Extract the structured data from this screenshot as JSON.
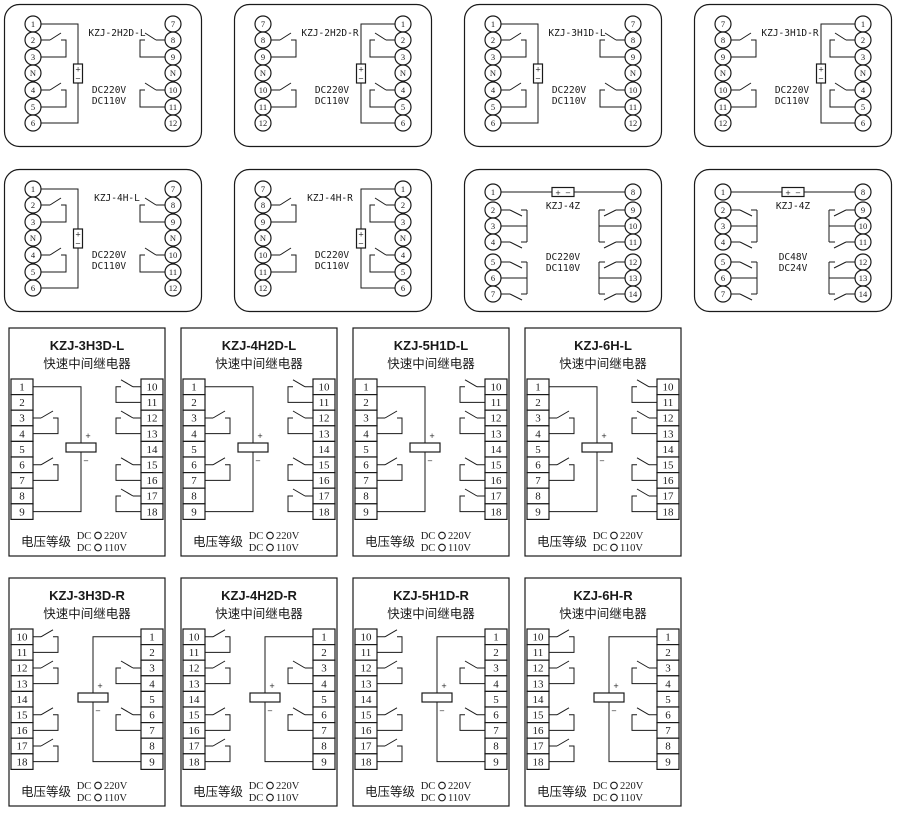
{
  "page": {
    "background": "#ffffff",
    "ink": "#1a1a1a"
  },
  "shared": {
    "plus": "+",
    "minus": "−"
  },
  "rows": [
    {
      "name": "row-1",
      "kind": "pill",
      "panels": [
        {
          "type": "pill-l",
          "title": "KZJ-2H2D-L",
          "voltages": [
            "DC220V",
            "DC110V"
          ],
          "left": [
            "1",
            "2",
            "3",
            "N",
            "4",
            "5",
            "6"
          ],
          "right": [
            "7",
            "8",
            "9",
            "N",
            "10",
            "11",
            "12"
          ]
        },
        {
          "type": "pill-r",
          "title": "KZJ-2H2D-R",
          "voltages": [
            "DC220V",
            "DC110V"
          ],
          "left": [
            "7",
            "8",
            "9",
            "N",
            "10",
            "11",
            "12"
          ],
          "right": [
            "1",
            "2",
            "3",
            "N",
            "4",
            "5",
            "6"
          ]
        },
        {
          "type": "pill-l",
          "title": "KZJ-3H1D-L",
          "voltages": [
            "DC220V",
            "DC110V"
          ],
          "left": [
            "1",
            "2",
            "3",
            "N",
            "4",
            "5",
            "6"
          ],
          "right": [
            "7",
            "8",
            "9",
            "N",
            "10",
            "11",
            "12"
          ]
        },
        {
          "type": "pill-r",
          "title": "KZJ-3H1D-R",
          "voltages": [
            "DC220V",
            "DC110V"
          ],
          "left": [
            "7",
            "8",
            "9",
            "N",
            "10",
            "11",
            "12"
          ],
          "right": [
            "1",
            "2",
            "3",
            "N",
            "4",
            "5",
            "6"
          ]
        }
      ]
    },
    {
      "name": "row-2",
      "kind": "pill",
      "panels": [
        {
          "type": "pill-l",
          "title": "KZJ-4H-L",
          "voltages": [
            "DC220V",
            "DC110V"
          ],
          "left": [
            "1",
            "2",
            "3",
            "N",
            "4",
            "5",
            "6"
          ],
          "right": [
            "7",
            "8",
            "9",
            "N",
            "10",
            "11",
            "12"
          ]
        },
        {
          "type": "pill-r",
          "title": "KZJ-4H-R",
          "voltages": [
            "DC220V",
            "DC110V"
          ],
          "left": [
            "7",
            "8",
            "9",
            "N",
            "10",
            "11",
            "12"
          ],
          "right": [
            "1",
            "2",
            "3",
            "N",
            "4",
            "5",
            "6"
          ]
        },
        {
          "type": "pill-z",
          "title": "KZJ-4Z",
          "voltages": [
            "DC220V",
            "DC110V"
          ],
          "left": [
            "1",
            "2",
            "3",
            "4",
            "5",
            "6",
            "7"
          ],
          "right": [
            "8",
            "9",
            "10",
            "11",
            "12",
            "13",
            "14"
          ]
        },
        {
          "type": "pill-z",
          "title": "KZJ-4Z",
          "voltages": [
            "DC48V",
            "DC24V"
          ],
          "left": [
            "1",
            "2",
            "3",
            "4",
            "5",
            "6",
            "7"
          ],
          "right": [
            "8",
            "9",
            "10",
            "11",
            "12",
            "13",
            "14"
          ]
        }
      ]
    },
    {
      "name": "row-3",
      "kind": "rect",
      "panels": [
        {
          "type": "rect-l",
          "title": "KZJ-3H3D-L",
          "subtitle": "快速中间继电器",
          "voltage_class": "电压等级",
          "options": [
            {
              "prefix": "DC",
              "value": "220V"
            },
            {
              "prefix": "DC",
              "value": "110V"
            }
          ],
          "left": [
            "1",
            "2",
            "3",
            "4",
            "5",
            "6",
            "7",
            "8",
            "9"
          ],
          "right": [
            "10",
            "11",
            "12",
            "13",
            "14",
            "15",
            "16",
            "17",
            "18"
          ]
        },
        {
          "type": "rect-l",
          "title": "KZJ-4H2D-L",
          "subtitle": "快速中间继电器",
          "voltage_class": "电压等级",
          "options": [
            {
              "prefix": "DC",
              "value": "220V"
            },
            {
              "prefix": "DC",
              "value": "110V"
            }
          ],
          "left": [
            "1",
            "2",
            "3",
            "4",
            "5",
            "6",
            "7",
            "8",
            "9"
          ],
          "right": [
            "10",
            "11",
            "12",
            "13",
            "14",
            "15",
            "16",
            "17",
            "18"
          ]
        },
        {
          "type": "rect-l",
          "title": "KZJ-5H1D-L",
          "subtitle": "快速中间继电器",
          "voltage_class": "电压等级",
          "options": [
            {
              "prefix": "DC",
              "value": "220V"
            },
            {
              "prefix": "DC",
              "value": "110V"
            }
          ],
          "left": [
            "1",
            "2",
            "3",
            "4",
            "5",
            "6",
            "7",
            "8",
            "9"
          ],
          "right": [
            "10",
            "11",
            "12",
            "13",
            "14",
            "15",
            "16",
            "17",
            "18"
          ]
        },
        {
          "type": "rect-l",
          "title": "KZJ-6H-L",
          "subtitle": "快速中间继电器",
          "voltage_class": "电压等级",
          "options": [
            {
              "prefix": "DC",
              "value": "220V"
            },
            {
              "prefix": "DC",
              "value": "110V"
            }
          ],
          "left": [
            "1",
            "2",
            "3",
            "4",
            "5",
            "6",
            "7",
            "8",
            "9"
          ],
          "right": [
            "10",
            "11",
            "12",
            "13",
            "14",
            "15",
            "16",
            "17",
            "18"
          ]
        }
      ]
    },
    {
      "name": "row-4",
      "kind": "rect",
      "panels": [
        {
          "type": "rect-r",
          "title": "KZJ-3H3D-R",
          "subtitle": "快速中间继电器",
          "voltage_class": "电压等级",
          "options": [
            {
              "prefix": "DC",
              "value": "220V"
            },
            {
              "prefix": "DC",
              "value": "110V"
            }
          ],
          "left": [
            "10",
            "11",
            "12",
            "13",
            "14",
            "15",
            "16",
            "17",
            "18"
          ],
          "right": [
            "1",
            "2",
            "3",
            "4",
            "5",
            "6",
            "7",
            "8",
            "9"
          ]
        },
        {
          "type": "rect-r",
          "title": "KZJ-4H2D-R",
          "subtitle": "快速中间继电器",
          "voltage_class": "电压等级",
          "options": [
            {
              "prefix": "DC",
              "value": "220V"
            },
            {
              "prefix": "DC",
              "value": "110V"
            }
          ],
          "left": [
            "10",
            "11",
            "12",
            "13",
            "14",
            "15",
            "16",
            "17",
            "18"
          ],
          "right": [
            "1",
            "2",
            "3",
            "4",
            "5",
            "6",
            "7",
            "8",
            "9"
          ]
        },
        {
          "type": "rect-r",
          "title": "KZJ-5H1D-R",
          "subtitle": "快速中间继电器",
          "voltage_class": "电压等级",
          "options": [
            {
              "prefix": "DC",
              "value": "220V"
            },
            {
              "prefix": "DC",
              "value": "110V"
            }
          ],
          "left": [
            "10",
            "11",
            "12",
            "13",
            "14",
            "15",
            "16",
            "17",
            "18"
          ],
          "right": [
            "1",
            "2",
            "3",
            "4",
            "5",
            "6",
            "7",
            "8",
            "9"
          ]
        },
        {
          "type": "rect-r",
          "title": "KZJ-6H-R",
          "subtitle": "快速中间继电器",
          "voltage_class": "电压等级",
          "options": [
            {
              "prefix": "DC",
              "value": "220V"
            },
            {
              "prefix": "DC",
              "value": "110V"
            }
          ],
          "left": [
            "10",
            "11",
            "12",
            "13",
            "14",
            "15",
            "16",
            "17",
            "18"
          ],
          "right": [
            "1",
            "2",
            "3",
            "4",
            "5",
            "6",
            "7",
            "8",
            "9"
          ]
        }
      ]
    }
  ]
}
